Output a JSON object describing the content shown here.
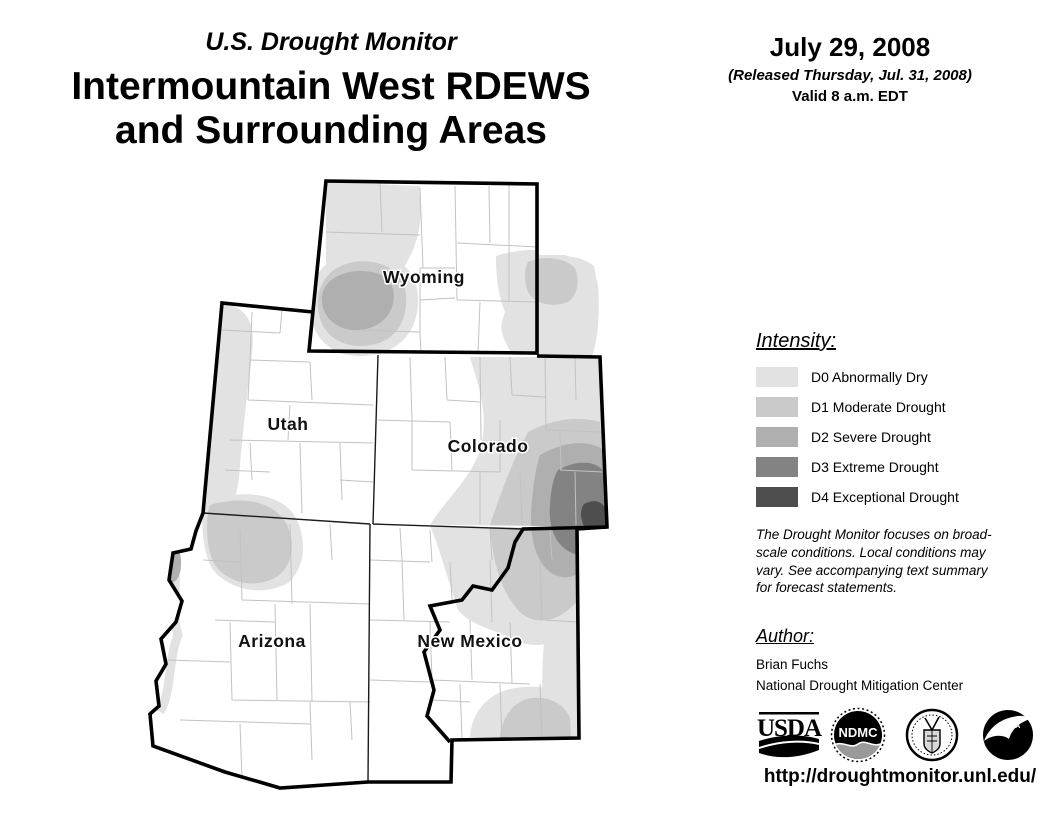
{
  "header": {
    "kicker": "U.S. Drought Monitor",
    "title_line1": "Intermountain West RDEWS",
    "title_line2": "and Surrounding Areas",
    "date": "July 29, 2008",
    "released": "(Released Thursday, Jul. 31, 2008)",
    "valid": "Valid 8 a.m. EDT"
  },
  "map": {
    "states": [
      {
        "id": "wyoming",
        "label": "Wyoming"
      },
      {
        "id": "utah",
        "label": "Utah"
      },
      {
        "id": "colorado",
        "label": "Colorado"
      },
      {
        "id": "arizona",
        "label": "Arizona"
      },
      {
        "id": "new-mexico",
        "label": "New Mexico"
      }
    ],
    "drought_areas": [
      {
        "area": "northwest Wyoming",
        "max_level": "D0"
      },
      {
        "area": "southwest Wyoming",
        "max_level": "D2"
      },
      {
        "area": "southeast Wyoming / Nebraska panhandle",
        "max_level": "D1"
      },
      {
        "area": "western Utah edge",
        "max_level": "D0"
      },
      {
        "area": "northwest Arizona / Utah border",
        "max_level": "D2"
      },
      {
        "area": "eastern Colorado",
        "max_level": "D4"
      },
      {
        "area": "northeast New Mexico",
        "max_level": "D3"
      },
      {
        "area": "southeast New Mexico",
        "max_level": "D1"
      }
    ]
  },
  "legend": {
    "title": "Intensity:",
    "items": [
      {
        "code": "D0",
        "label": "D0 Abnormally Dry",
        "color": "#e2e2e2"
      },
      {
        "code": "D1",
        "label": "D1 Moderate Drought",
        "color": "#cacaca"
      },
      {
        "code": "D2",
        "label": "D2 Severe Drought",
        "color": "#afafaf"
      },
      {
        "code": "D3",
        "label": "D3 Extreme Drought",
        "color": "#838383"
      },
      {
        "code": "D4",
        "label": "D4 Exceptional Drought",
        "color": "#4e4e4e"
      }
    ]
  },
  "disclaimer": "The Drought Monitor focuses on broad-scale conditions. Local conditions may vary. See accompanying text summary for forecast statements.",
  "author": {
    "title": "Author:",
    "name": "Brian Fuchs",
    "org": "National Drought Mitigation Center"
  },
  "logos": [
    {
      "name": "usda-logo",
      "text": "USDA"
    },
    {
      "name": "ndmc-logo",
      "text": "NDMC"
    },
    {
      "name": "unl-seal",
      "text": ""
    },
    {
      "name": "noaa-logo",
      "text": "NOAA"
    }
  ],
  "url": "http://droughtmonitor.unl.edu/"
}
